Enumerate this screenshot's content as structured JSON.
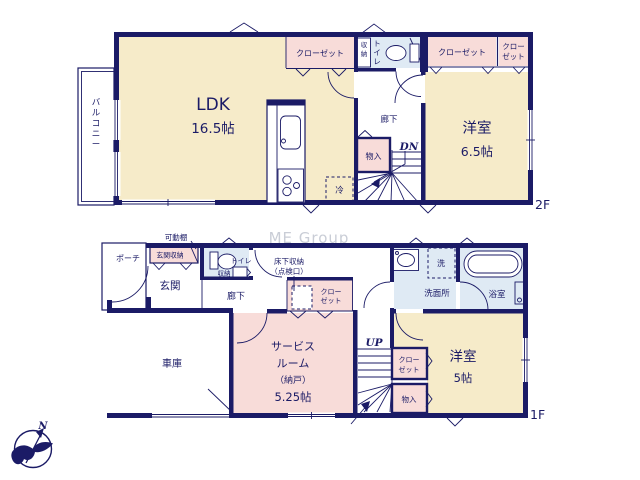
{
  "watermark": "ME Group",
  "compass": {
    "north": "N"
  },
  "colors": {
    "wall": "#1b1b66",
    "room_cream": "#f6ebc9",
    "room_pink": "#f8dcd9",
    "room_blue": "#dfeaf4",
    "watermark": "#c4c8d2"
  },
  "floor2": {
    "floor_label": "2F",
    "balcony": "バルコニー",
    "ldk": "LDK",
    "ldk_size": "16.5帖",
    "closet_top": "クローゼット",
    "storage_v": "収納",
    "toilet_v": "トイレ",
    "closet_right": "クローゼット",
    "closet_far_1": "クロー",
    "closet_far_2": "ゼット",
    "hallway": "廊下",
    "storage_small": "物入",
    "stairs": "DN",
    "bedroom": "洋室",
    "bedroom_size": "6.5帖",
    "fridge": "冷"
  },
  "floor1": {
    "floor_label": "1F",
    "shelf": "可動棚",
    "porch": "ポーチ",
    "entrance_storage": "玄関収納",
    "entrance": "玄関",
    "toilet": "トイレ",
    "toilet_storage": "収納",
    "hallway": "廊下",
    "underfloor_1": "床下収納",
    "underfloor_2": "（点検口）",
    "closet_mid_1": "クロー",
    "closet_mid_2": "ゼット",
    "service_1": "サービス",
    "service_2": "ルーム",
    "service_3": "（納戸）",
    "service_4": "5.25帖",
    "stairs": "UP",
    "closet_right_1": "クロー",
    "closet_right_2": "ゼット",
    "storage_small": "物入",
    "bedroom": "洋室",
    "bedroom_size": "5帖",
    "washroom": "洗面所",
    "washer": "洗",
    "bathroom": "浴室",
    "garage": "車庫"
  }
}
